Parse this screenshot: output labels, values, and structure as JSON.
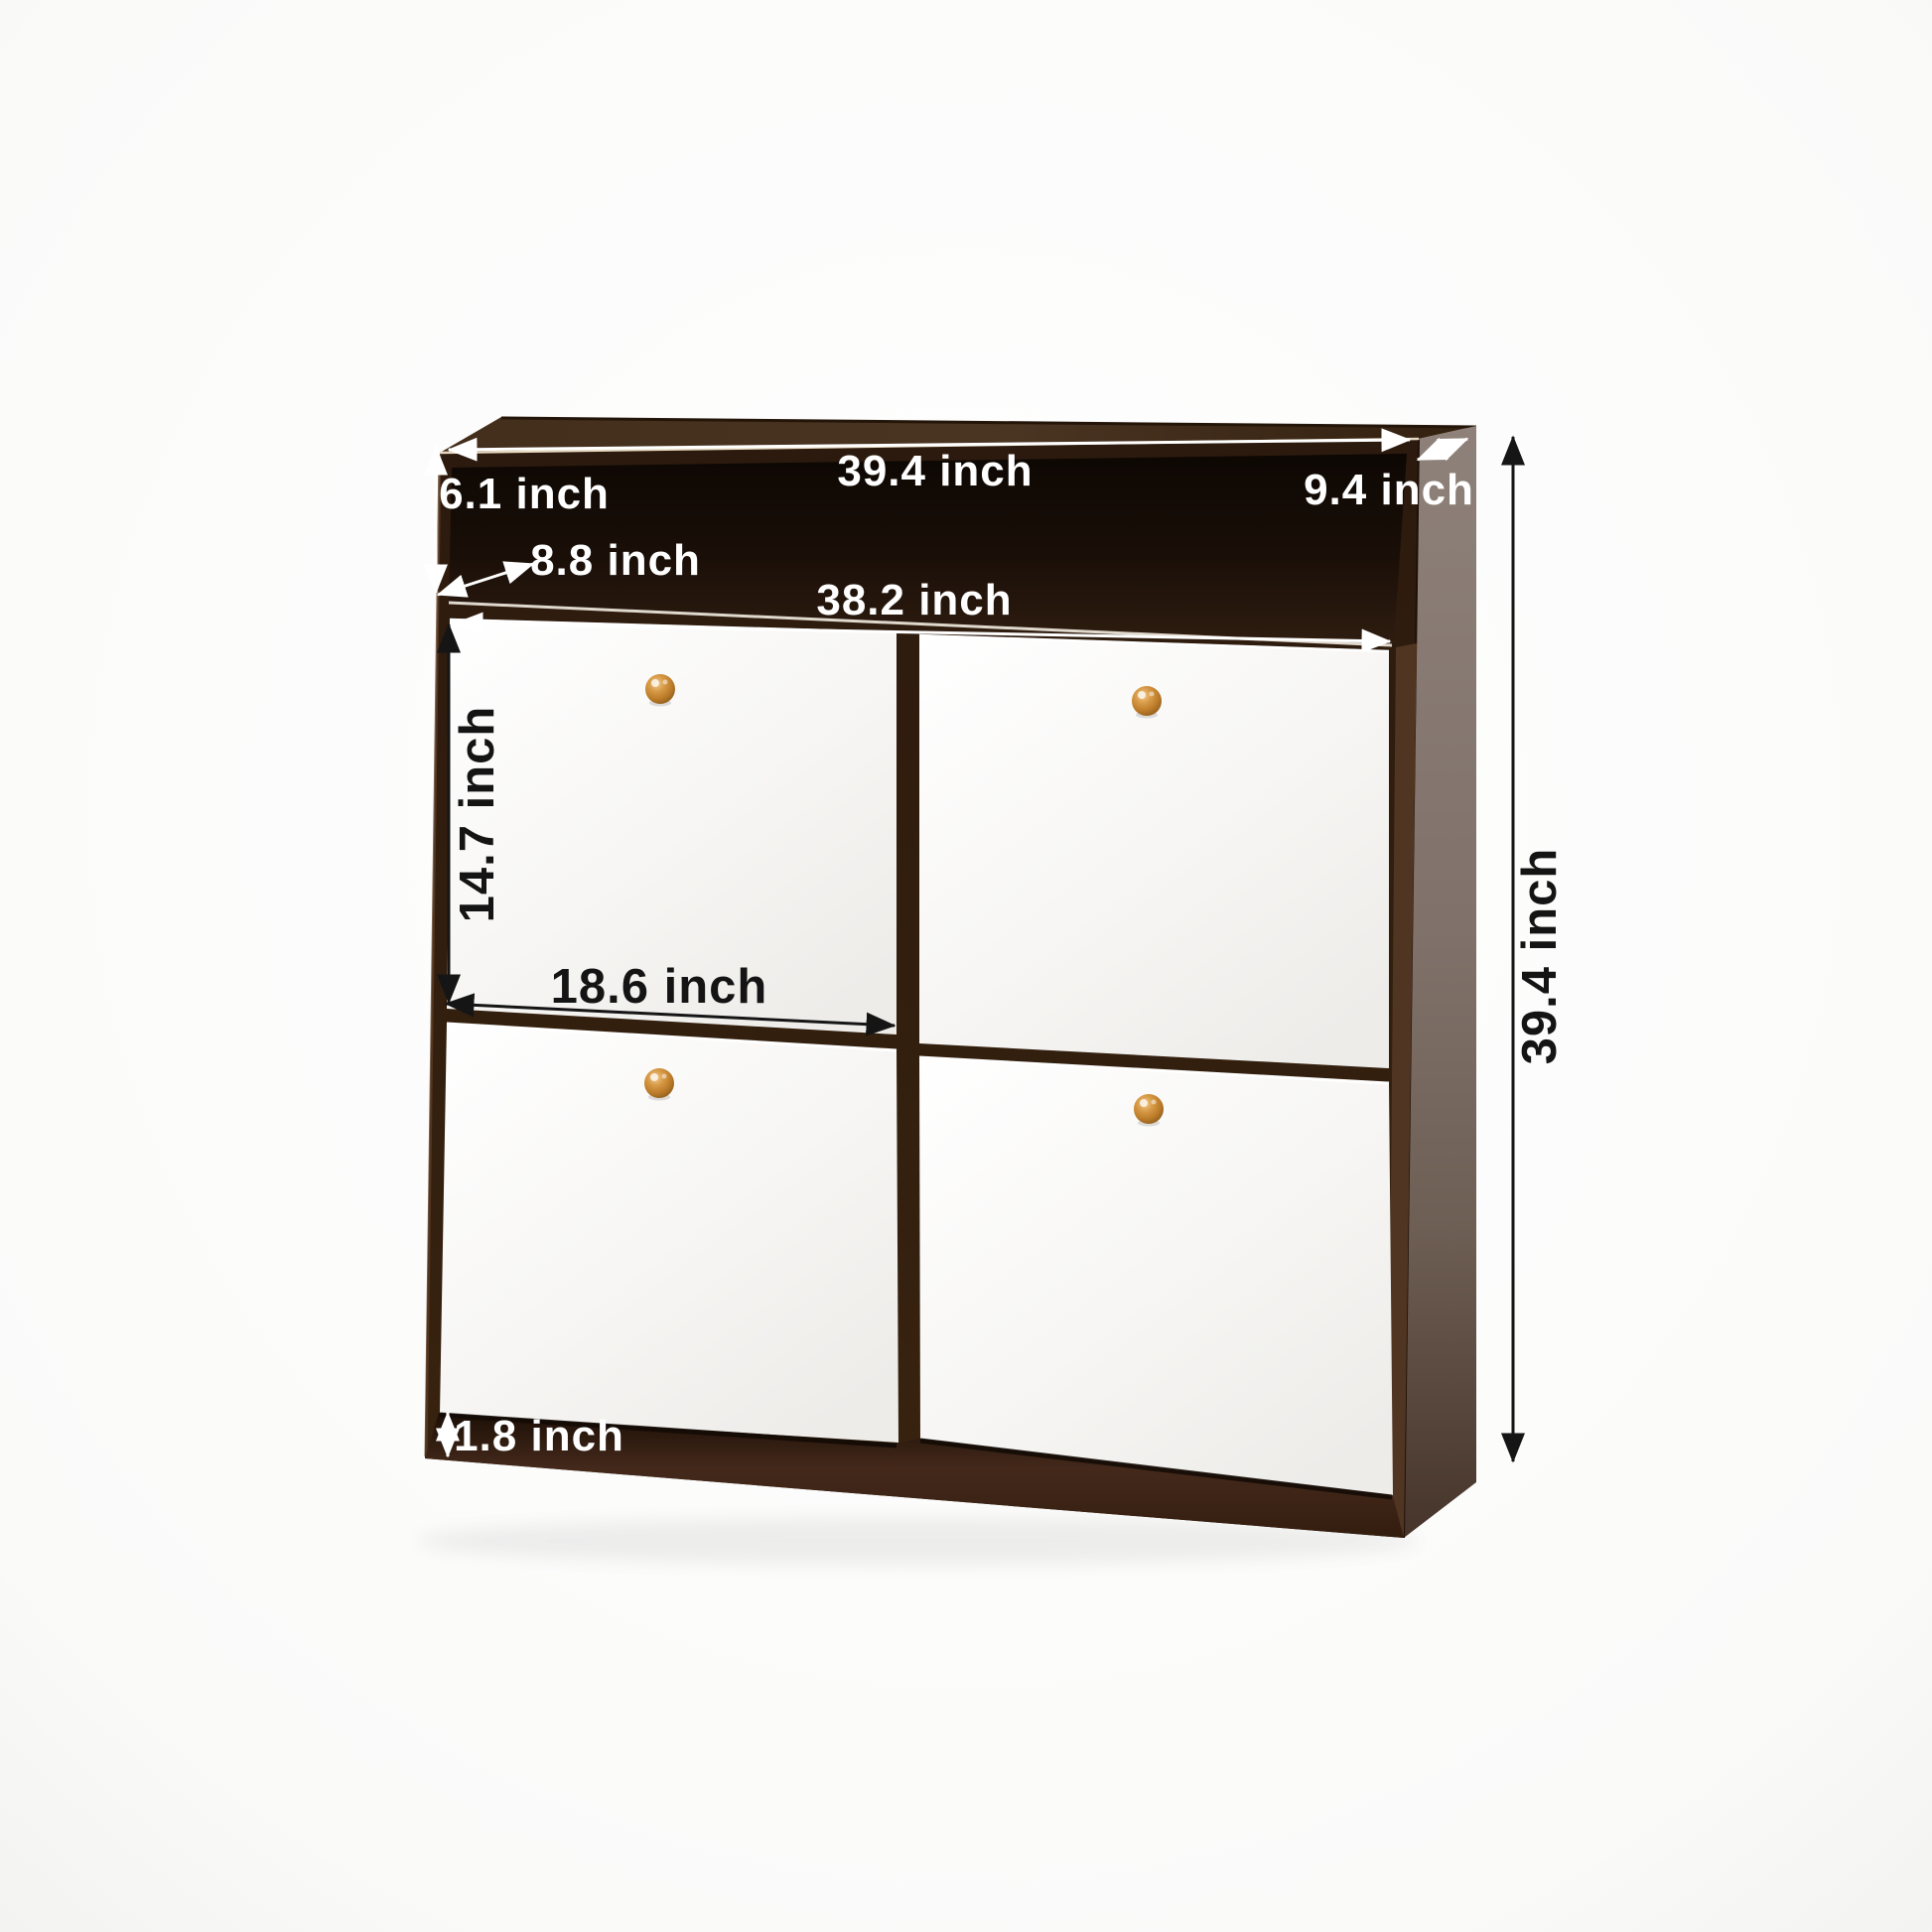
{
  "figure": {
    "type": "product-dimension-diagram",
    "units": "inch"
  },
  "dimensions": {
    "overall_width": "39.4 inch",
    "overall_height": "39.4 inch",
    "overall_depth": "9.4 inch",
    "top_compartment_height": "6.1 inch",
    "top_compartment_depth": "8.8 inch",
    "inner_width": "38.2 inch",
    "door_height": "14.7 inch",
    "door_width": "18.6 inch",
    "base_height": "1.8 inch"
  },
  "colors": {
    "background": "#fbfbfa",
    "frame_dark_brown": "#2e1b10",
    "shelf_interior": "#140c06",
    "top_face": "#3f2b1a",
    "side_panel_top": "#8e8179",
    "side_panel_bottom": "#4a382c",
    "door_white": "#f7f6f4",
    "knob_orange": "#c5862f",
    "dim_text_light": "#ffffff",
    "dim_text_dark": "#141414"
  }
}
